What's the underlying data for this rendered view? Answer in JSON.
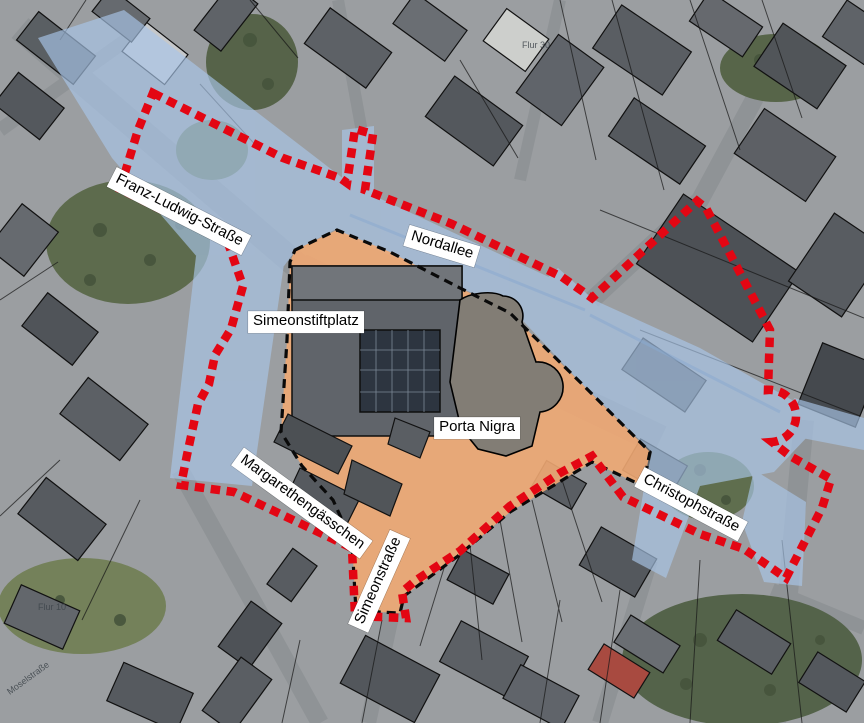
{
  "labels": {
    "franz_ludwig": {
      "text": "Franz-Ludwig-Straße"
    },
    "nordallee": {
      "text": "Nordallee"
    },
    "simeonstiftplatz": {
      "text": "Simeonstiftplatz"
    },
    "porta_nigra": {
      "text": "Porta Nigra"
    },
    "margarethengaesschen": {
      "text": "Margarethengässchen"
    },
    "simeonstrasse": {
      "text": "Simeonstraße"
    },
    "christophstrasse": {
      "text": "Christophstraße"
    }
  },
  "map_texts": {
    "flur_30": "Flur 30",
    "flur_10": "Flur 10",
    "moselstrasse": "Moselstraße"
  },
  "colors": {
    "boundary_red": "#e30613",
    "pedestrian_boundary_black": "#0a0a0a",
    "traffic_blue": "#a9c6e8",
    "pedestrian_orange": "#f0a873",
    "label_bg": "#ffffff",
    "label_text": "#000000"
  }
}
